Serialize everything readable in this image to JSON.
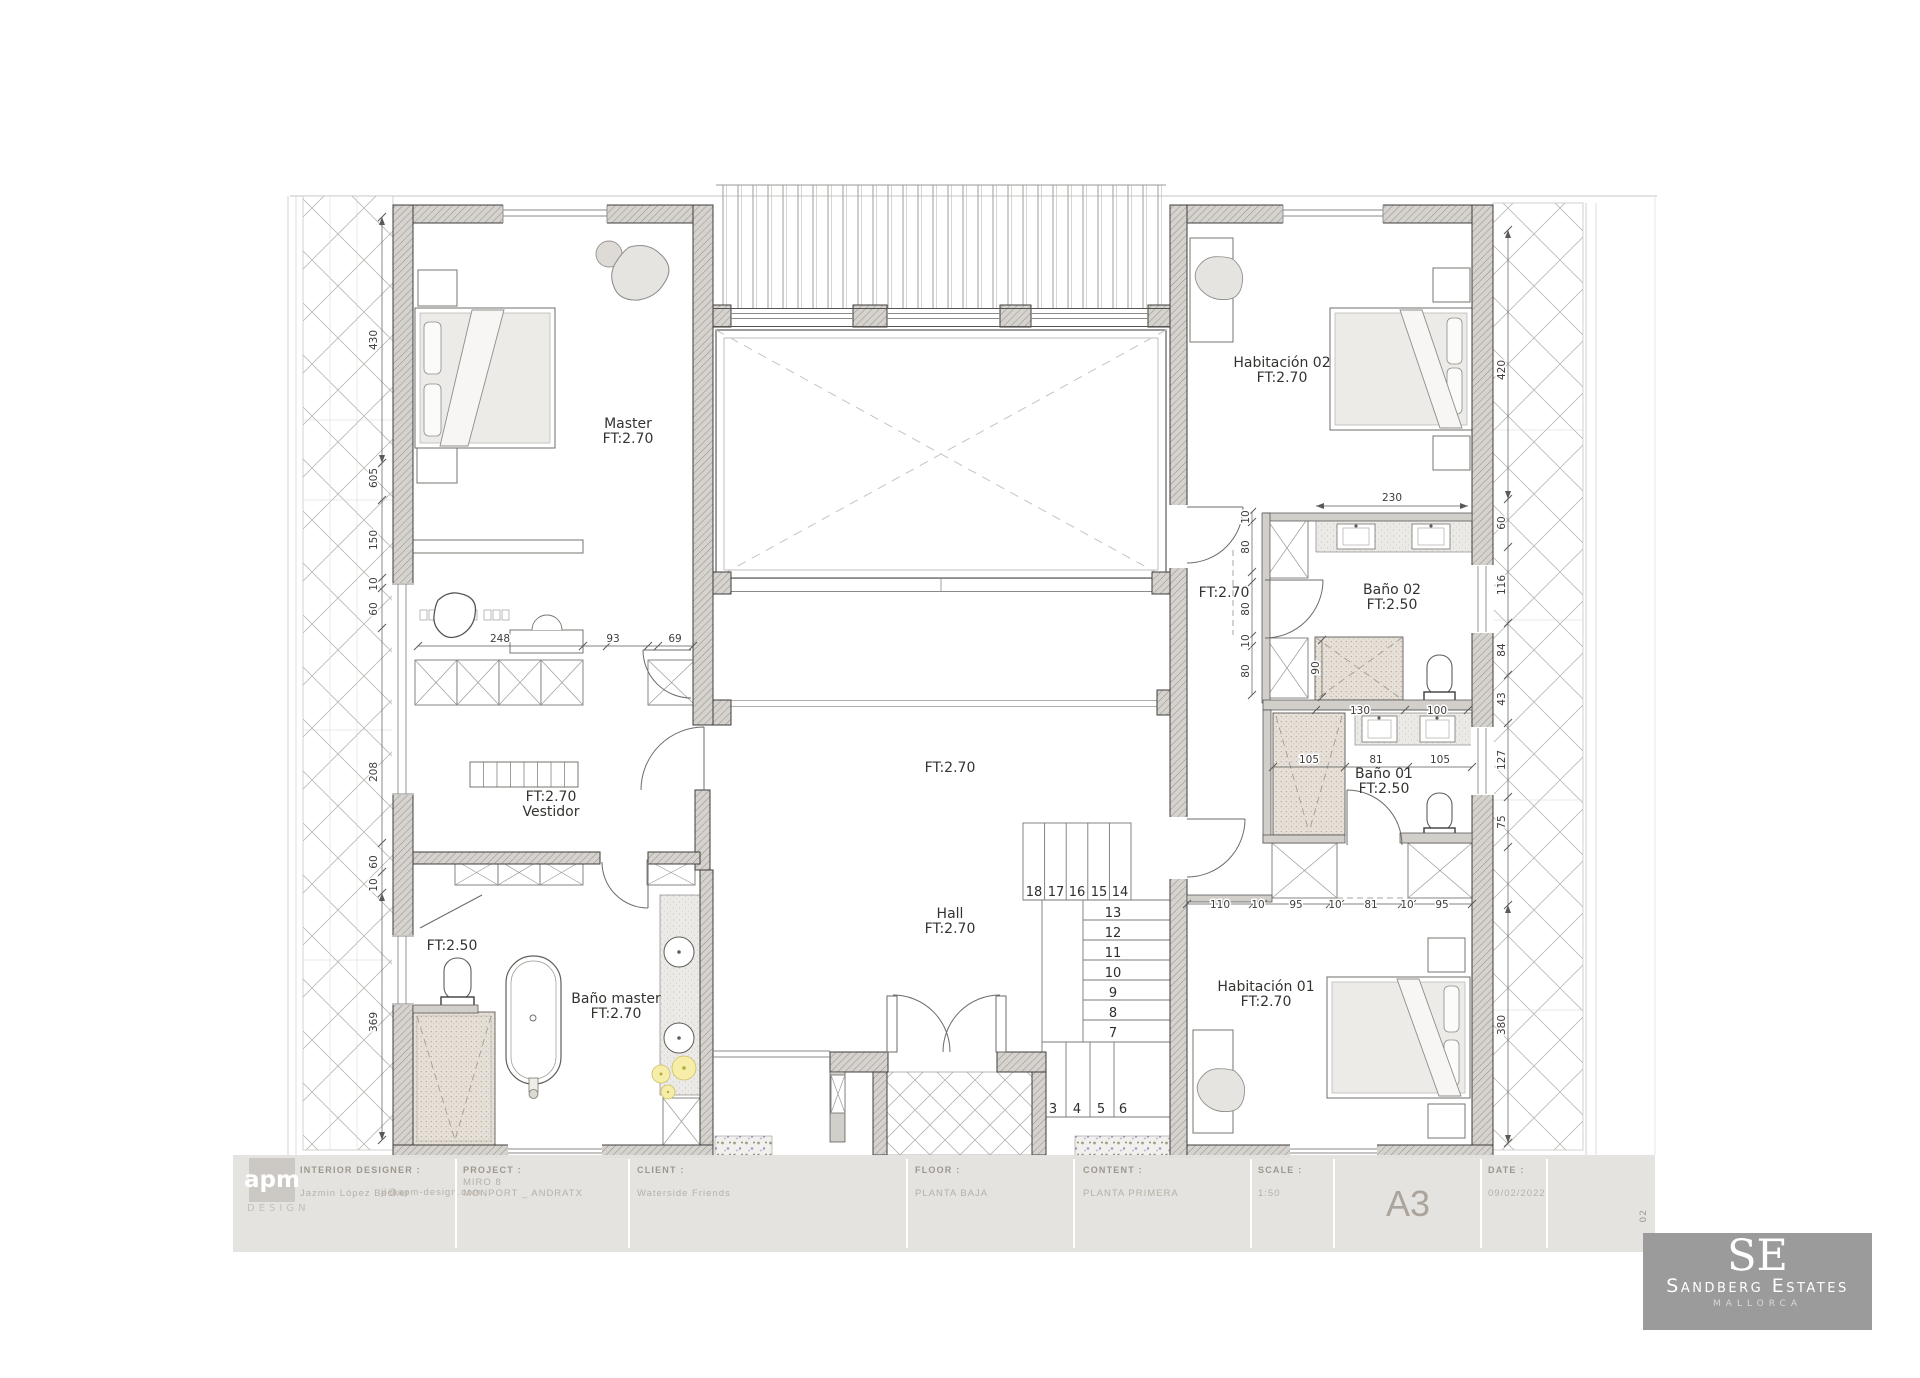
{
  "rooms": {
    "master": {
      "name": "Master",
      "ft": "FT:2.70"
    },
    "vestidor": {
      "ft": "FT:2.70",
      "name": "Vestidor"
    },
    "bano_master": {
      "name": "Baño master",
      "ft": "FT:2.70"
    },
    "wc_master": {
      "ft": "FT:2.50"
    },
    "void_label": {
      "ft": "FT:2.70"
    },
    "hall": {
      "name": "Hall",
      "ft": "FT:2.70"
    },
    "corridor": {
      "ft": "FT:2.70"
    },
    "hab02": {
      "name": "Habitación 02",
      "ft": "FT:2.70"
    },
    "bano02": {
      "name": "Baño 02",
      "ft": "FT:2.50"
    },
    "bano01": {
      "name": "Baño 01",
      "ft": "FT:2.50"
    },
    "hab01": {
      "name": "Habitación 01",
      "ft": "FT:2.70"
    }
  },
  "dims": {
    "left": [
      "430",
      "605",
      "150",
      "10",
      "60",
      "208",
      "60",
      "10",
      "369"
    ],
    "right": [
      "420",
      "60",
      "116",
      "84",
      "43",
      "127",
      "75",
      "380"
    ],
    "master_row": [
      "248",
      "93",
      "69"
    ],
    "bano02_top": "230",
    "bano02_left": [
      "10",
      "80",
      "80",
      "10",
      "80"
    ],
    "bano02_inner": "90",
    "bano02_bottom": [
      "130",
      "100"
    ],
    "bano01_row": [
      "105",
      "81",
      "105"
    ],
    "wing_bottom": [
      "110",
      "10",
      "95",
      "10",
      "81",
      "10",
      "95"
    ]
  },
  "stairs": {
    "upper": [
      "18",
      "17",
      "16",
      "15",
      "14"
    ],
    "mid": [
      "13",
      "12",
      "11",
      "10",
      "9",
      "8",
      "7"
    ],
    "lower": [
      "3",
      "4",
      "5",
      "6"
    ]
  },
  "title_block": {
    "logo_line1": "apm",
    "logo_line2": "DESIGN",
    "interior_designer_label": "INTERIOR DESIGNER :",
    "interior_designer_name": "Jazmin López Becker",
    "interior_designer_email": "jl@apm-design.com",
    "project_label": "PROJECT :",
    "project_line1": "MIRO 8",
    "project_line2": "MONPORT _ ANDRATX",
    "client_label": "CLIENT :",
    "client_value": "Waterside Friends",
    "floor_label": "FLOOR :",
    "floor_value": "PLANTA BAJA",
    "content_label": "CONTENT :",
    "content_value": "PLANTA PRIMERA",
    "scale_label": "SCALE :",
    "scale_value": "1:50",
    "sheet": "A3",
    "date_label": "DATE :",
    "date_value": "09/02/2022",
    "rev": "02"
  },
  "brand": {
    "initials": "SE",
    "name": "Sandberg Estates",
    "location": "MALLORCA"
  }
}
